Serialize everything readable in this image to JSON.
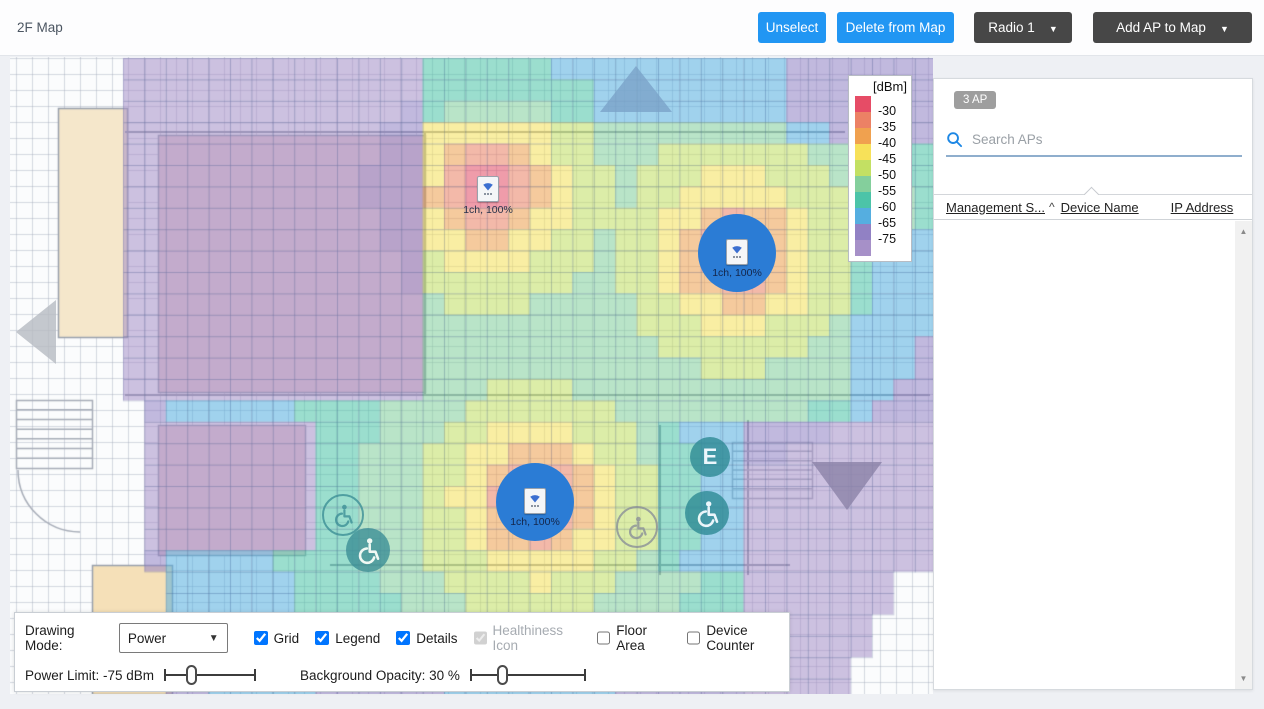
{
  "header": {
    "title": "2F Map",
    "unselect_label": "Unselect",
    "delete_label": "Delete from Map",
    "radio_label": "Radio 1",
    "add_ap_label": "Add AP to Map",
    "caret": "▼",
    "accent_blue": "#2196f3",
    "dark_button": "#474747"
  },
  "legend": {
    "title": "[dBm]",
    "colors": [
      "#e64c66",
      "#ec8165",
      "#f0a14f",
      "#f7e159",
      "#c3e063",
      "#84cf9c",
      "#4cc4a8",
      "#55aee0",
      "#9181c4",
      "#a690c8"
    ],
    "labels": [
      "-30",
      "-35",
      "-40",
      "-45",
      "-50",
      "-55",
      "-60",
      "-65",
      "-75"
    ]
  },
  "map": {
    "cell_size": 21.4,
    "origin": [
      16,
      58
    ],
    "heat_alpha": 0.55,
    "thresholds": [
      -30,
      -35,
      -40,
      -45,
      -50,
      -55,
      -60,
      -65,
      -75
    ],
    "decay": {
      "p0": -22,
      "slope": 30,
      "d0": 14
    },
    "aps": [
      {
        "x": 488,
        "y": 190,
        "label": "1ch, 100%",
        "selected": false
      },
      {
        "x": 737,
        "y": 253,
        "label": "1ch, 100%",
        "selected": true
      },
      {
        "x": 535,
        "y": 502,
        "label": "1ch, 100%",
        "selected": true
      }
    ],
    "selected_circle_radius": 39,
    "selected_circle_color": "#2b7cd5",
    "no_heat_zones": [
      [
        16,
        57,
        127,
        398
      ],
      [
        16,
        398,
        155,
        572
      ],
      [
        16,
        572,
        92,
        694
      ],
      [
        92,
        565,
        172,
        694
      ],
      [
        903,
        572,
        933,
        694
      ],
      [
        878,
        618,
        903,
        694
      ],
      [
        856,
        655,
        878,
        694
      ]
    ],
    "penalty_zones": [
      [
        130,
        57,
        425,
        397,
        25
      ],
      [
        155,
        420,
        307,
        560,
        25
      ],
      [
        748,
        430,
        933,
        694,
        18
      ],
      [
        307,
        612,
        748,
        694,
        8
      ],
      [
        845,
        230,
        933,
        430,
        8
      ],
      [
        790,
        57,
        933,
        145,
        12
      ],
      [
        660,
        425,
        748,
        575,
        6
      ],
      [
        430,
        57,
        790,
        115,
        8
      ]
    ],
    "rooms": [
      {
        "rect": [
          58,
          108,
          127,
          337
        ],
        "fill": "#f5e7cb"
      },
      {
        "rect": [
          92,
          565,
          172,
          694
        ],
        "fill": "#f5e0b8"
      },
      {
        "rect": [
          158,
          135,
          425,
          392
        ],
        "fill": "#e7ccd1"
      },
      {
        "rect": [
          158,
          425,
          305,
          555
        ],
        "fill": "#e7ccd1"
      }
    ],
    "walls": [
      [
        125,
        132,
        845,
        132
      ],
      [
        425,
        132,
        425,
        395
      ],
      [
        125,
        395,
        930,
        395
      ],
      [
        660,
        425,
        660,
        575
      ],
      [
        748,
        420,
        748,
        575
      ],
      [
        330,
        565,
        790,
        565
      ]
    ],
    "stairs": [
      {
        "x": 16,
        "y": 400,
        "w": 76,
        "h": 68,
        "steps": 7
      },
      {
        "x": 732,
        "y": 442,
        "w": 80,
        "h": 56,
        "steps": 6
      }
    ],
    "fine_grid": 16,
    "arrows": [
      {
        "type": "left",
        "x": 16,
        "y": 300,
        "w": 40,
        "h": 64,
        "color": "#b6bac2"
      },
      {
        "type": "up",
        "x": 600,
        "y": 66,
        "w": 72,
        "h": 46,
        "color": "#7ba3c8"
      },
      {
        "type": "down",
        "x": 812,
        "y": 462,
        "w": 70,
        "h": 48,
        "color": "#8b82a8"
      }
    ],
    "wheelchairs": [
      {
        "x": 322,
        "y": 494,
        "size": 42,
        "style": "outline",
        "color": "#3d8f96"
      },
      {
        "x": 346,
        "y": 528,
        "size": 44,
        "style": "filled",
        "color": "#3d8f96"
      },
      {
        "x": 616,
        "y": 506,
        "size": 42,
        "style": "outline",
        "color": "#8a8f98"
      },
      {
        "x": 685,
        "y": 491,
        "size": 44,
        "style": "filled",
        "color": "#2e8a94"
      }
    ],
    "elevator": {
      "x": 690,
      "y": 437,
      "size": 40,
      "label": "E",
      "color": "#2e8a94"
    }
  },
  "side_panel": {
    "count_badge": "3 AP",
    "search_placeholder": "Search APs",
    "columns": [
      {
        "label": "Management S...",
        "sort": "^"
      },
      {
        "label": "Device Name",
        "sort": ""
      },
      {
        "label": "IP Address",
        "sort": ""
      }
    ],
    "scroll_up_glyph": "▲",
    "scroll_down_glyph": "▼"
  },
  "controls": {
    "drawing_mode_label": "Drawing Mode:",
    "drawing_mode_value": "Power",
    "caret": "▼",
    "checkboxes": [
      {
        "label": "Grid",
        "checked": true,
        "disabled": false
      },
      {
        "label": "Legend",
        "checked": true,
        "disabled": false
      },
      {
        "label": "Details",
        "checked": true,
        "disabled": false
      },
      {
        "label": "Healthiness Icon",
        "checked": true,
        "disabled": true
      },
      {
        "label": "Floor Area",
        "checked": false,
        "disabled": false
      },
      {
        "label": "Device Counter",
        "checked": false,
        "disabled": false
      }
    ],
    "power_limit_label": "Power Limit: -75 dBm",
    "power_limit_percent": 29,
    "power_slider_width": 92,
    "opacity_label": "Background Opacity: 30 %",
    "opacity_percent": 28,
    "opacity_slider_width": 116,
    "opacity_label_margin": 44
  }
}
